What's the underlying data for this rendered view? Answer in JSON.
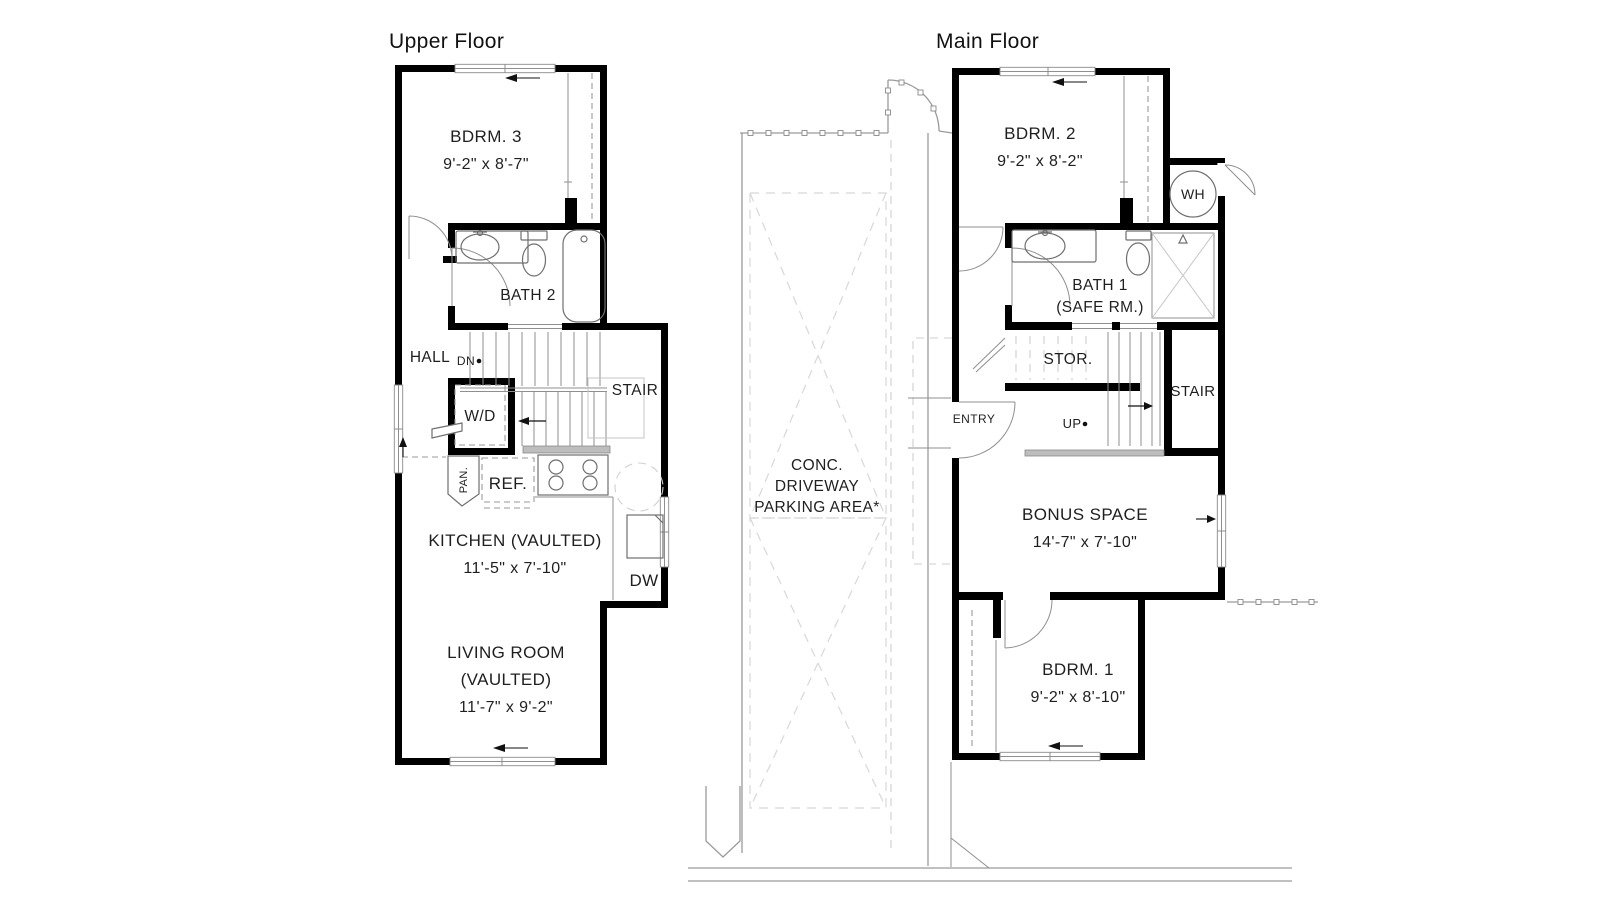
{
  "upper_floor": {
    "title": "Upper Floor",
    "bdrm3_name": "BDRM. 3",
    "bdrm3_dims": "9'-2\" x 8'-7\"",
    "bath2": "BATH 2",
    "hall": "HALL",
    "dn": "DN",
    "stair": "STAIR",
    "wd": "W/D",
    "pan": "PAN.",
    "ref": "REF.",
    "dw": "DW",
    "kitchen_name": "KITCHEN (VAULTED)",
    "kitchen_dims": "11'-5\" x 7'-10\"",
    "living_name": "LIVING ROOM",
    "living_vaulted": "(VAULTED)",
    "living_dims": "11'-7\" x 9'-2\""
  },
  "main_floor": {
    "title": "Main Floor",
    "bdrm2_name": "BDRM. 2",
    "bdrm2_dims": "9'-2\" x 8'-2\"",
    "wh": "WH",
    "bath1_name": "BATH 1",
    "bath1_sub": "(SAFE RM.)",
    "stor": "STOR.",
    "stair": "STAIR",
    "entry": "ENTRY",
    "up": "UP",
    "bonus_name": "BONUS SPACE",
    "bonus_dims": "14'-7\" x 7'-10\"",
    "bdrm1_name": "BDRM. 1",
    "bdrm1_dims": "9'-2\" x 8'-10\""
  },
  "site": {
    "driveway_line1": "CONC.",
    "driveway_line2": "DRIVEWAY",
    "driveway_line3": "PARKING AREA*"
  }
}
